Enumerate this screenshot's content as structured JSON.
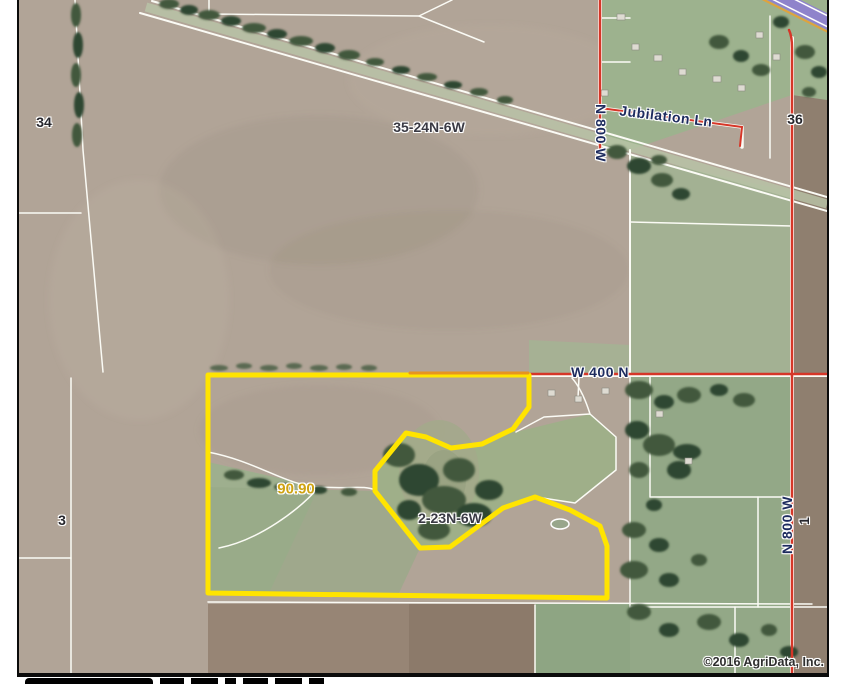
{
  "map": {
    "type": "aerial-plat-map",
    "copyright": "©2016 AgriData, Inc.",
    "labels": {
      "section_34": "34",
      "section_36": "36",
      "section_3": "3",
      "section_1": "1",
      "township_top": "35-24N-6W",
      "township_parcel": "2-23N-6W",
      "road_n800w_top": "N 800 W",
      "road_n800w_right": "N 800 W",
      "road_jubilation": "Jubilation Ln",
      "road_w400n": "W 400 N",
      "parcel_acreage": "90.90"
    },
    "colors": {
      "parcel_outline": "#ffe400",
      "road_red": "#d63628",
      "road_orange": "#e6941f",
      "interstate_purple": "#8f83cb",
      "road_label_navy": "#1d2b5e",
      "acreage_yellow": "#cfa312"
    }
  }
}
